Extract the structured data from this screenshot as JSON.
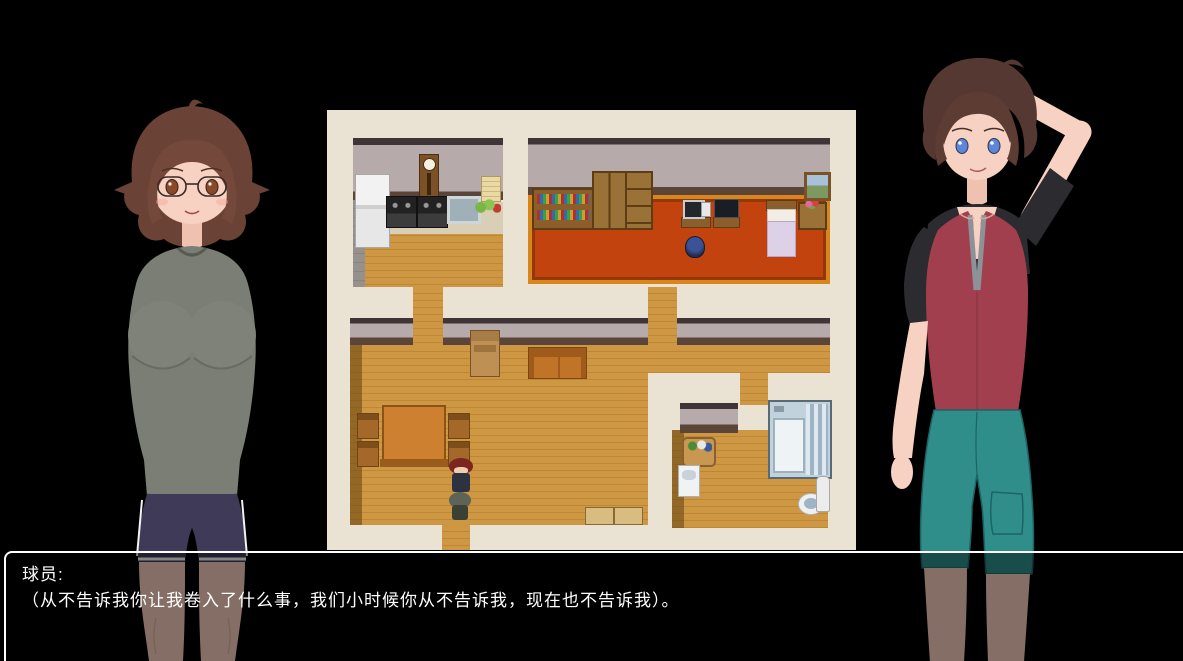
{
  "screen": {
    "background": "#000000"
  },
  "dialogue": {
    "speaker": "球员:",
    "line": "（从不告诉我你让我卷入了什么事，我们小时候你从不告诉我，现在也不告诉我）。",
    "continue_indicator": "▼",
    "border_color": "#ffffff",
    "text_color": "#ffffff"
  },
  "map": {
    "background": "#eae2d3",
    "floor_wood": "#c99440",
    "wall": "#b6aaaa",
    "carpet": "#c2430e",
    "rooms": [
      {
        "name": "kitchen",
        "items": [
          "refrigerator",
          "grandfather-clock",
          "wall-note",
          "stove",
          "stove",
          "sink",
          "vegetables"
        ]
      },
      {
        "name": "bedroom",
        "items": [
          "bookshelf",
          "wardrobe",
          "dresser",
          "computer-desk",
          "tv",
          "stool",
          "bed",
          "flower-table",
          "painting"
        ]
      },
      {
        "name": "living-room",
        "items": [
          "cardboard-box",
          "sofa",
          "dining-table",
          "chair",
          "chair",
          "chair",
          "chair",
          "floor-mats"
        ]
      },
      {
        "name": "bathroom",
        "items": [
          "laundry-basket",
          "wash-sink",
          "bathtub",
          "toilet",
          "water-heater"
        ]
      }
    ],
    "sprites": [
      {
        "name": "girl-sprite-facing-down",
        "hair": "#7c2622"
      },
      {
        "name": "boy-sprite-facing-up",
        "hair": "#5d6456"
      }
    ]
  },
  "characters": {
    "left": {
      "name": "young-woman",
      "hair": "#6b4236",
      "eyes": "#8a4a2a",
      "shirt": "#7a7e74",
      "shorts": "#3f3a57",
      "skin": "#f7d2c3"
    },
    "right": {
      "name": "young-man",
      "hair": "#553831",
      "eyes": "#5f84d8",
      "vest": "#a13f4e",
      "sleeves": "#2b2b30",
      "shorts": "#2f8d8a",
      "skin": "#f7d2c3"
    }
  }
}
